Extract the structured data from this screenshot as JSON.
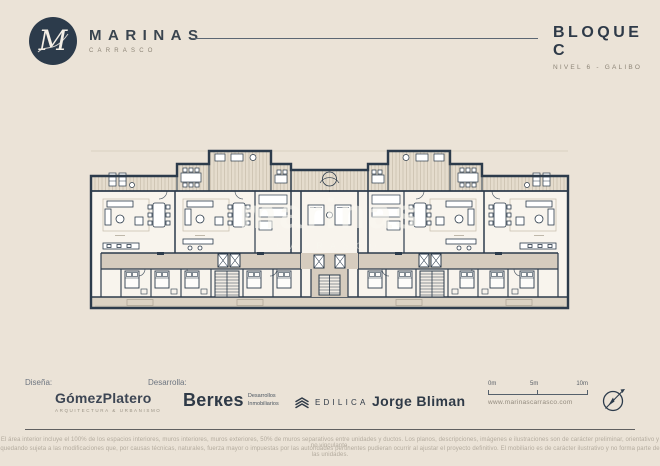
{
  "header": {
    "brand_name": "MARINAS",
    "brand_sub": "CARRASCO",
    "logo_letter": "M",
    "block_title": "BLOQUE C",
    "block_sub": "NIVEL 6 - GALIBO"
  },
  "watermark": {
    "line1": "marinas",
    "line2": "CARRASCO"
  },
  "footer": {
    "design_label": "Diseña:",
    "design_firm": "GómezPlatero",
    "design_firm_sub": "ARQUITECTURA & URBANISMO",
    "develop_label": "Desarrolla:",
    "developer1_name": "Berкes",
    "developer1_sub1": "Desarrollos",
    "developer1_sub2": "Inmobiliarios",
    "developer2_name": "EDILICA",
    "developer3_name": "Jorge Bliman",
    "scale_0": "0m",
    "scale_5": "5m",
    "scale_10": "10m",
    "website": "www.marinascarrasco.com"
  },
  "disclaimer": {
    "line1": "El área interior incluye el 100% de los espacios interiores, muros interiores, muros exteriores, 50% de muros separativos entre unidades y ductos. Los planos, descripciones, imágenes e ilustraciones son de carácter preliminar, orientativo y no vinculante,",
    "line2": "quedando sujeta a las modificaciones que, por causas técnicas, naturales, fuerza mayor o impuestas por las autoridades pertinentes pudieran ocurrir al ajustar el proyecto definitivo. El mobiliario es de carácter ilustrativo y no forma parte de las unidades."
  },
  "colors": {
    "background": "#ebe3d7",
    "wall_navy": "#2c3b4b",
    "corridor_tan": "#d6ccbe",
    "terrace": "#e5dccd",
    "plan_fill": "#f8f4ed"
  }
}
